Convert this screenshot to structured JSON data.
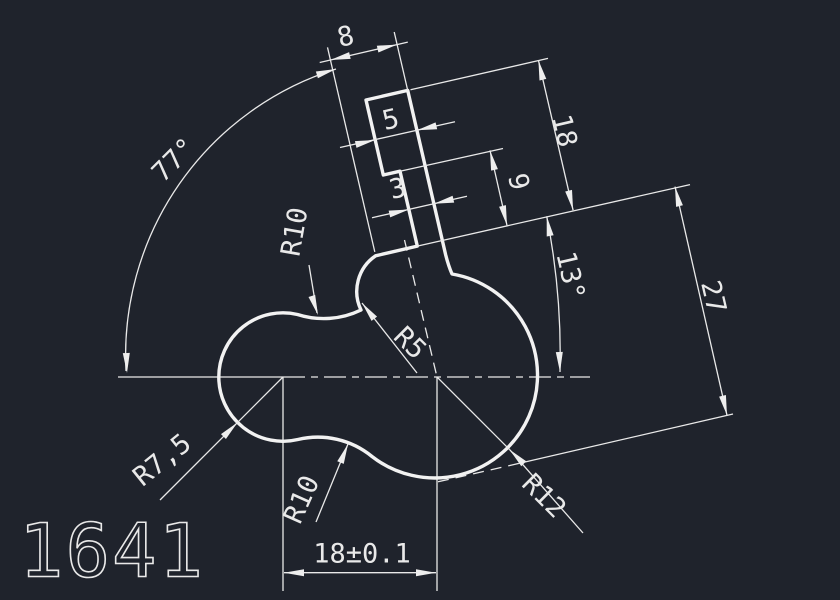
{
  "app": {
    "type": "cad-drawing-canvas",
    "background_color": "#1f232c",
    "line_color": "#e9e9e9",
    "outline_color": "#f2f2f2"
  },
  "drawing": {
    "part_number": "1641"
  },
  "dimensions": {
    "width_top_8": {
      "label": "8"
    },
    "width_upper_5": {
      "label": "5"
    },
    "width_mid_3": {
      "label": "3"
    },
    "length_18": {
      "label": "18"
    },
    "length_9": {
      "label": "9"
    },
    "length_27": {
      "label": "27"
    },
    "angle_77": {
      "label": "77°"
    },
    "angle_13": {
      "label": "13°"
    },
    "radius_top_r10": {
      "label": "R10"
    },
    "radius_neck_r5": {
      "label": "R5"
    },
    "radius_left_r75": {
      "label": "R7,5"
    },
    "radius_bottom_r10": {
      "label": "R10"
    },
    "radius_right_r12": {
      "label": "R12"
    },
    "center_distance": {
      "label": "18±0.1"
    }
  }
}
